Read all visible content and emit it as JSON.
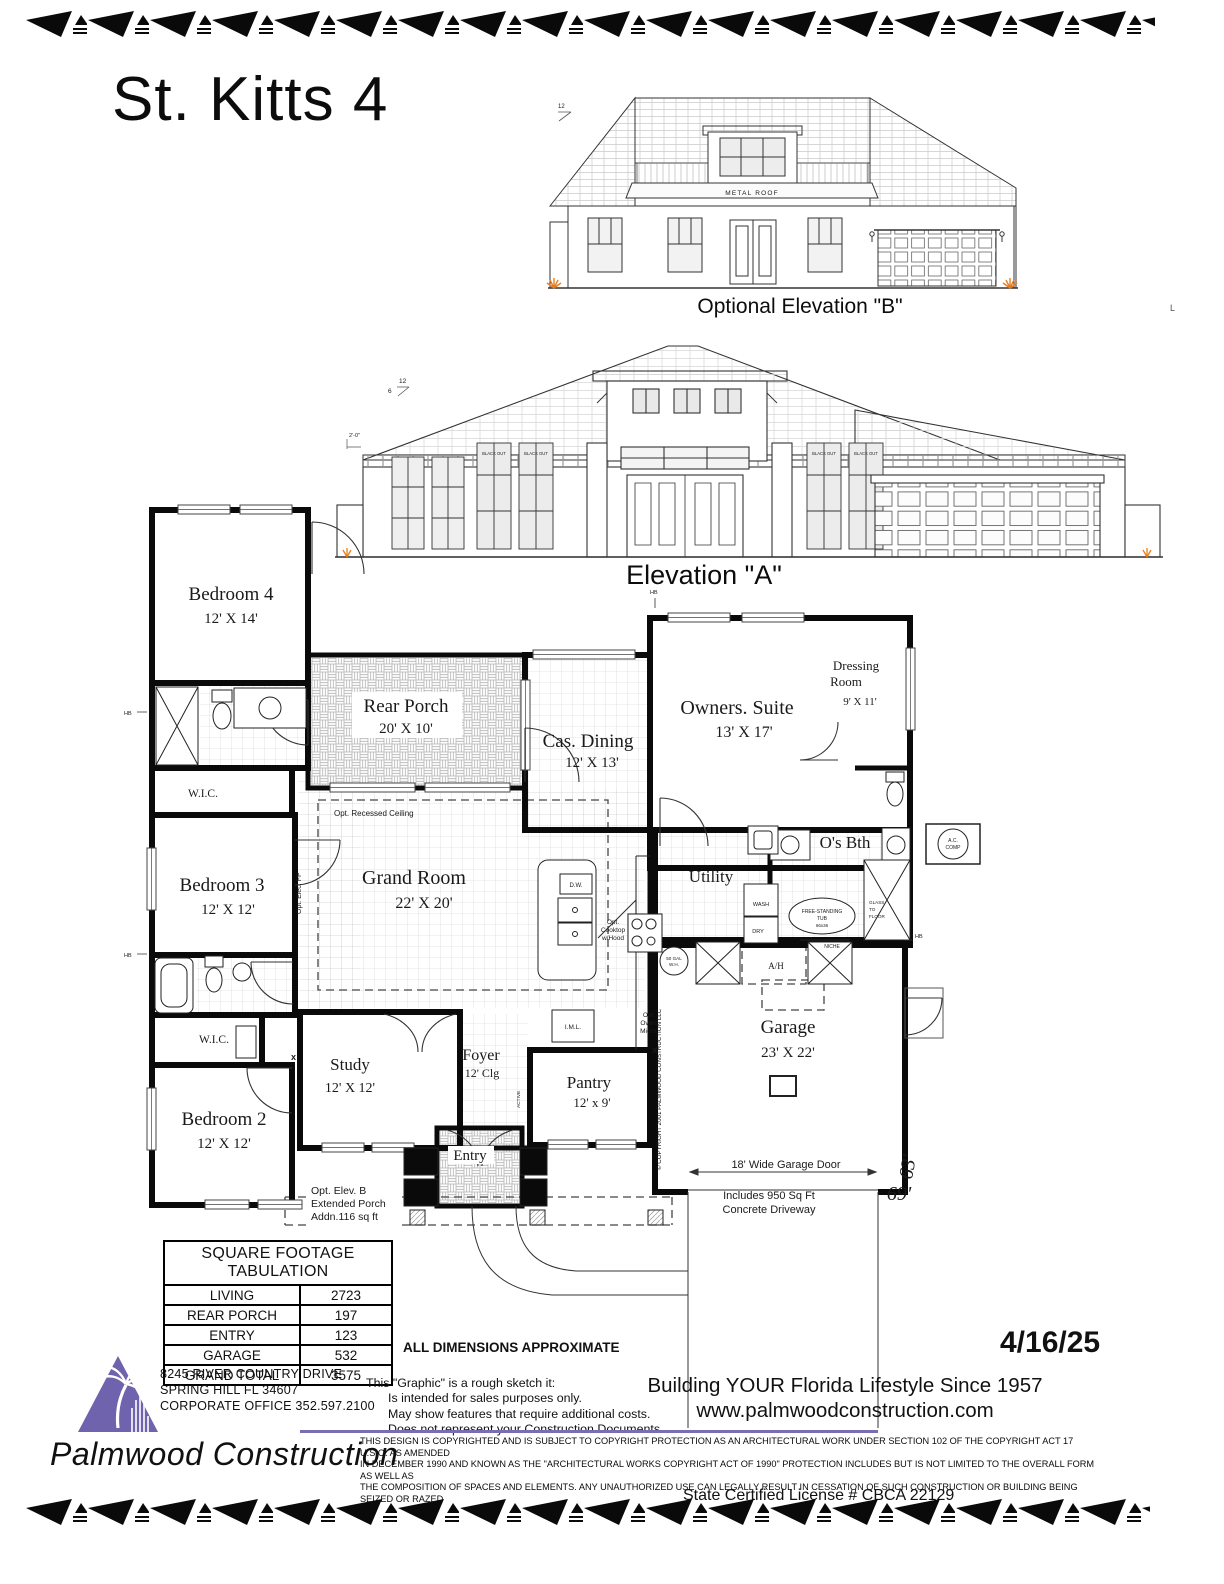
{
  "header": {
    "title": "St. Kitts 4"
  },
  "colors": {
    "logo_purple": "#6e63ac",
    "rule_purple": "#7a6db1",
    "accent_orange": "#e87d1e",
    "tag_blue": "#4a7fd6",
    "ink": "#0a0a0a"
  },
  "elevation_b": {
    "caption": "Optional Elevation \"B\"",
    "metal_roof": "METAL ROOF",
    "pitch": "12",
    "margin_mark": "L"
  },
  "elevation_a": {
    "caption": "Elevation \"A\"",
    "blackout": "BLACK OUT",
    "pitch_rise": "12",
    "pitch_run": "6",
    "offset_note": "2'-0\""
  },
  "floor_plan": {
    "rooms": {
      "bedroom4": {
        "name": "Bedroom 4",
        "dims": "12' X 14'"
      },
      "bedroom3": {
        "name": "Bedroom 3",
        "dims": "12' X 12'"
      },
      "bedroom2": {
        "name": "Bedroom 2",
        "dims": "12' X 12'"
      },
      "rear_porch": {
        "name": "Rear Porch",
        "dims": "20' X 10'"
      },
      "grand_room": {
        "name": "Grand Room",
        "dims": "22' X 20'"
      },
      "cas_dining": {
        "name": "Cas. Dining",
        "dims": "12' X 13'"
      },
      "owners_suite": {
        "name": "Owners. Suite",
        "dims": "13' X 17'"
      },
      "dressing_room": {
        "name1": "Dressing",
        "name2": "Room",
        "dims": "9' X 11'"
      },
      "obth": {
        "name": "O's Bth"
      },
      "utility": {
        "name": "Utility"
      },
      "study": {
        "name": "Study",
        "dims": "12' X 12'"
      },
      "foyer": {
        "name": "Foyer",
        "dims": "12' Clg"
      },
      "pantry": {
        "name": "Pantry",
        "dims": "12' x 9'"
      },
      "entry": {
        "name": "Entry"
      },
      "garage": {
        "name": "Garage",
        "dims": "23' X 22'"
      },
      "wic": "W.I.C."
    },
    "ann": {
      "recessed": "Opt. Recessed Ceiling",
      "elec_fp": "Opt. Elec. FP",
      "cooktop1": "Opt.",
      "cooktop2": "Cooktop",
      "cooktop3": "w/Hood",
      "oven1": "Opt.",
      "oven2": "Oven/",
      "oven3": "Micro.",
      "dw": "D.W.",
      "iml": "I.M.L.",
      "wash": "WASH",
      "dry": "DRY",
      "wh1": "50 GAL",
      "wh2": "W.H.",
      "ah": "A/H",
      "tub1": "FREE-STANDING",
      "tub2": "TUB",
      "tub3": "66x36",
      "glass1": "GLASS",
      "glass2": "TO",
      "glass3": "FLOOR",
      "niche": "NICHE",
      "ac1": "A.C.",
      "ac2": "COMP",
      "hb": "HB",
      "active": "ACTIVE",
      "garage_door": "18' Wide Garage Door",
      "driveway1": "Includes 950 Sq Ft",
      "driveway2": "Concrete Driveway",
      "ext_porch1": "Opt. Elev. B",
      "ext_porch2": "Extended Porch",
      "ext_porch3": "Addn.116 sq ft",
      "copyright_vert": "© COPYRIGHT 2001 PALMWOOD CONSTRUCTION LLC",
      "d69": "69'",
      "d63": "63'"
    }
  },
  "sqft_table": {
    "title": "SQUARE FOOTAGE TABULATION",
    "rows": [
      {
        "label": "LIVING",
        "value": "2723"
      },
      {
        "label": "REAR PORCH",
        "value": "197"
      },
      {
        "label": "ENTRY",
        "value": "123"
      },
      {
        "label": "GARAGE",
        "value": "532"
      },
      {
        "label": "GRAND TOTAL",
        "value": "3575"
      }
    ]
  },
  "footer": {
    "all_dims": "ALL DIMENSIONS APPROXIMATE",
    "sketch1": "This \"Graphic\" is a rough sketch it:",
    "sketch2": "Is intended for sales purposes only.",
    "sketch3": "May show features that require additional costs.",
    "sketch4": "Does not represent your Construction Documents.",
    "address1": "8245 RIVER COUNTRY DRIVE",
    "address2": "SPRING HILL FL 34607",
    "address3": "CORPORATE OFFICE 352.597.2100",
    "company": "Palmwood Construction",
    "tagline": "Building YOUR Florida Lifestyle Since 1957",
    "website": "www.palmwoodconstruction.com",
    "date": "4/16/25",
    "copyright1": "THIS DESIGN IS COPYRIGHTED AND IS SUBJECT TO COPYRIGHT PROTECTION AS AN ARCHITECTURAL WORK UNDER SECTION 102 OF THE COPYRIGHT ACT 17 U.S.O. AS AMENDED",
    "copyright2": "IN DECEMBER 1990 AND KNOWN AS THE \"ARCHITECTURAL WORKS COPYRIGHT ACT OF 1990\" PROTECTION INCLUDES BUT IS NOT LIMITED TO THE OVERALL FORM AS WELL AS",
    "copyright3": "THE COMPOSITION OF SPACES AND ELEMENTS. ANY UNAUTHORIZED USE CAN LEGALLY RESULT IN CESSATION OF SUCH CONSTRUCTION OR BUILDING BEING SEIZED OR RAZED",
    "license": "State Certified License # CBCA 22129"
  }
}
